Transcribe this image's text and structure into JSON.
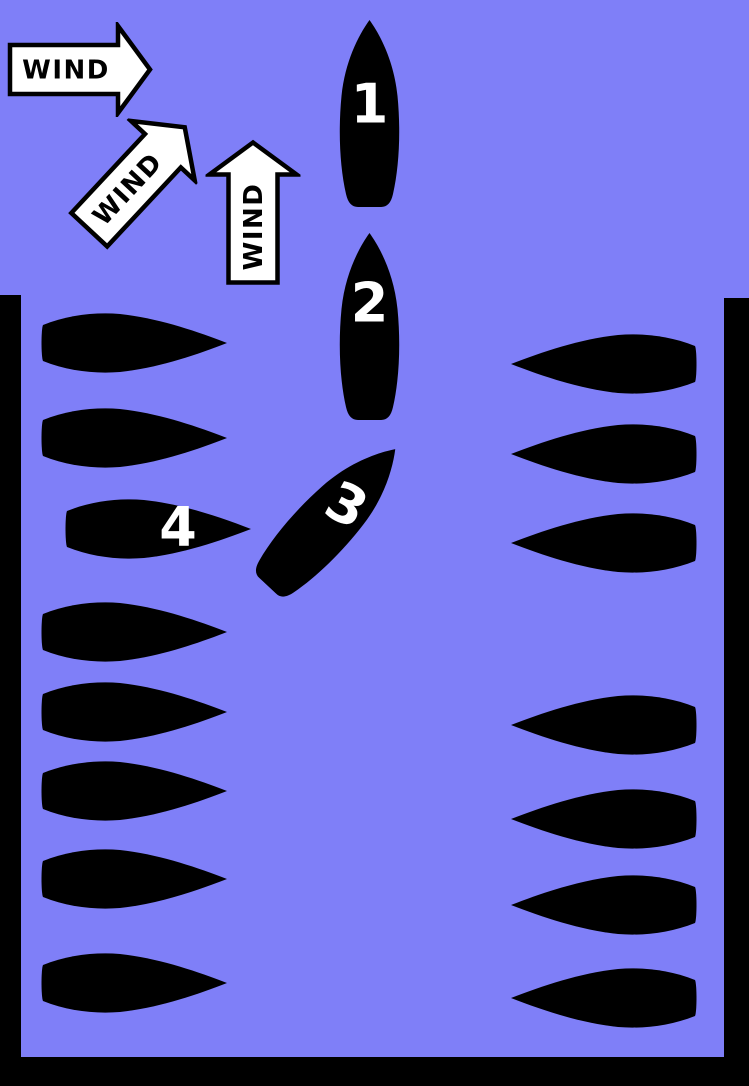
{
  "diagram_title": "harbor-docking-wind-diagram",
  "colors": {
    "water": "#7f7ff8",
    "wall": "#000000",
    "hull": "#000000",
    "arrow_fill": "#ffffff",
    "arrow_outline": "#000000",
    "number": "#ffffff",
    "wind_text": "#000000"
  },
  "wind_arrows": [
    {
      "label": "WIND",
      "direction": "east"
    },
    {
      "label": "WIND",
      "direction": "northeast"
    },
    {
      "label": "WIND",
      "direction": "north"
    }
  ],
  "boats": {
    "b1": {
      "number": "1"
    },
    "b2": {
      "number": "2"
    },
    "b3": {
      "number": "3"
    },
    "b4": {
      "number": "4"
    }
  },
  "docked": {
    "left_count": 7,
    "right_count": 7,
    "empty_berth_side": "right"
  }
}
